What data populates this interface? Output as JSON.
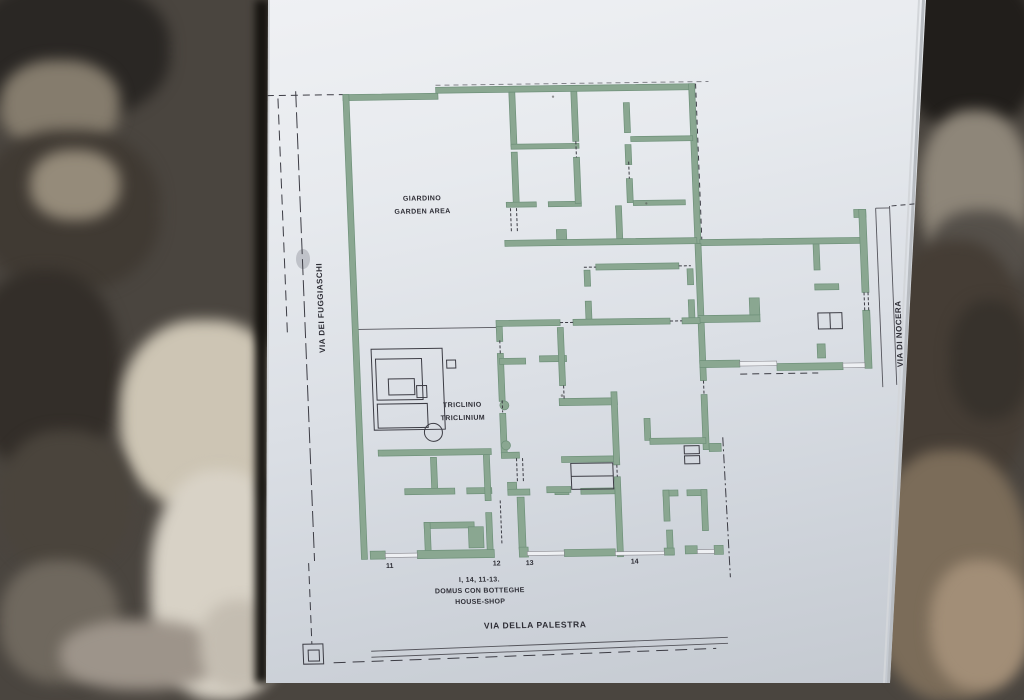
{
  "sign": {
    "plan_labels": {
      "garden_it": "GIARDINO",
      "garden_en": "GARDEN AREA",
      "triclinium_it": "TRICLINIO",
      "triclinium_en": "TRICLINIUM"
    },
    "street_labels": {
      "west": "VIA DEI FUGGIASCHI",
      "east": "VIA DI NOCERA",
      "south": "VIA DELLA PALESTRA"
    },
    "entrance_numbers": [
      "11",
      "12",
      "13",
      "14"
    ],
    "caption": {
      "address": "I, 14, 11-13.",
      "name_it": "DOMUS CON BOTTEGHE",
      "name_en": "HOUSE-SHOP"
    },
    "colors": {
      "wall_fill": "#8aa791",
      "wall_edge": "#6e9079",
      "ink": "#2e2e36",
      "sign_surface": "#e3e6eb"
    }
  }
}
